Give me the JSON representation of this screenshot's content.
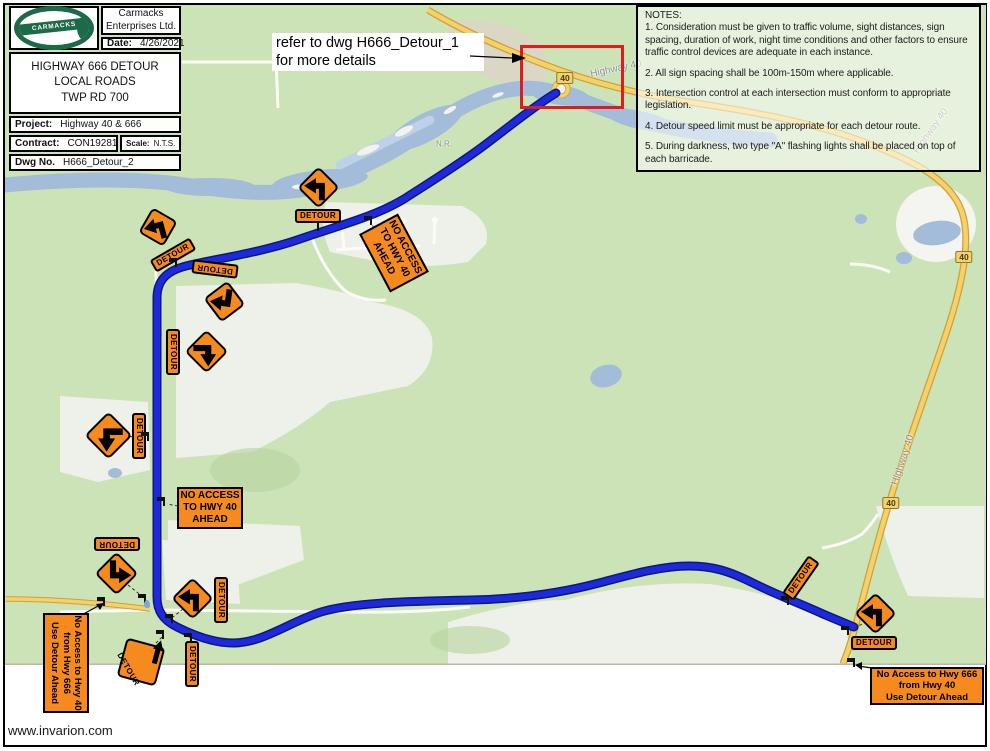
{
  "colors": {
    "route_blue": "#1c2adc",
    "sign_orange": "#f68a1e",
    "highway_yellow": "#f7d168",
    "water": "#a3bcd9",
    "map_green": "#cbe3b6",
    "field_gray": "#eef0ea",
    "callout_red": "#e01b1b"
  },
  "title_block": {
    "logo_text": "CARMACKS",
    "company_line1": "Carmacks",
    "company_line2": "Enterprises Ltd.",
    "date_label": "Date:",
    "date_value": "4/26/2021",
    "drawing_title_line1": "HIGHWAY 666 DETOUR",
    "drawing_title_line2": "LOCAL ROADS",
    "drawing_title_line3": "TWP RD 700",
    "project_label": "Project:",
    "project_value": "Highway 40 & 666",
    "contract_label": "Contract:",
    "contract_value": "CON19281",
    "scale_label": "Scale:",
    "scale_value": "N.T.S.",
    "dwg_label": "Dwg No.",
    "dwg_value": "H666_Detour_2"
  },
  "callout": {
    "line1": "refer to dwg H666_Detour_1",
    "line2": "for more details"
  },
  "notes": {
    "heading": "NOTES:",
    "items": [
      "1. Consideration must be given to traffic volume, sight distances, sign spacing, duration of work, night time conditions and other factors to ensure traffic control devices are adequate in each instance.",
      "2. All sign spacing shall be 100m-150m where applicable.",
      "3. Intersection control at each intersection must conform to appropriate legislation.",
      "4. Detour speed limit must be appropriate for each detour route.",
      "5. During darkness, two type \"A\" flashing lights shall be placed on top of each barricade."
    ]
  },
  "footer": {
    "website": "www.invarion.com"
  },
  "map": {
    "shields": [
      {
        "label": "40",
        "x": 565,
        "y": 78
      },
      {
        "label": "40",
        "x": 964,
        "y": 257
      },
      {
        "label": "40",
        "x": 891,
        "y": 503
      }
    ],
    "road_labels": [
      {
        "text": "Highway 40",
        "x": 616,
        "y": 69,
        "rot": -12
      },
      {
        "text": "Highway 40",
        "x": 931,
        "y": 131,
        "rot": -55
      },
      {
        "text": "Highway 40",
        "x": 903,
        "y": 460,
        "rot": -72
      },
      {
        "text": "N.R.",
        "x": 444,
        "y": 144,
        "rot": 0
      }
    ],
    "signs": [
      {
        "id": "detour-sign-a",
        "x": 318,
        "y": 187,
        "size": 30,
        "rot": 0,
        "arrow": "up-left",
        "plaque": {
          "text": "DETOUR",
          "x": 318,
          "y": 216,
          "rot": 0
        }
      },
      {
        "id": "detour-sign-b",
        "x": 158,
        "y": 227,
        "size": 29,
        "rot": -15,
        "arrow": "up-left",
        "plaque": {
          "text": "DETOUR",
          "x": 173,
          "y": 255,
          "rot": -30
        }
      },
      {
        "id": "detour-sign-c",
        "x": 224,
        "y": 301,
        "size": 30,
        "rot": 8,
        "arrow": "down-left",
        "plaque": {
          "text": "DETOUR",
          "x": 215,
          "y": 269,
          "rot": 187
        }
      },
      {
        "id": "detour-sign-d",
        "x": 206,
        "y": 351,
        "size": 31,
        "rot": 0,
        "arrow": "right-down",
        "plaque": {
          "text": "DETOUR",
          "x": 173,
          "y": 352,
          "rot": 90
        }
      },
      {
        "id": "detour-sign-e",
        "x": 108,
        "y": 435,
        "size": 34,
        "rot": 0,
        "arrow": "left-down",
        "plaque": {
          "text": "DETOUR",
          "x": 139,
          "y": 436,
          "rot": 90
        }
      },
      {
        "id": "detour-sign-f",
        "x": 116,
        "y": 573,
        "size": 31,
        "rot": 0,
        "arrow": "down-right",
        "plaque": {
          "text": "DETOUR",
          "x": 117,
          "y": 544,
          "rot": 180
        }
      },
      {
        "id": "detour-sign-g",
        "x": 141,
        "y": 662,
        "size": 40,
        "rot": -30,
        "arrow": "ne",
        "inner_text": "DETOUR"
      },
      {
        "id": "detour-sign-h",
        "x": 192,
        "y": 598,
        "size": 30,
        "rot": 0,
        "arrow": "up-left",
        "plaque": {
          "text": "DETOUR",
          "x": 221,
          "y": 600,
          "rot": 90
        }
      },
      {
        "id": "detour-sign-i",
        "plaque_only": true,
        "plaque": {
          "text": "DETOUR",
          "x": 192,
          "y": 664,
          "rot": 90
        }
      },
      {
        "id": "detour-sign-j",
        "x": 875,
        "y": 613,
        "size": 30,
        "rot": 0,
        "arrow": "up-left",
        "plaque": {
          "text": "DETOUR",
          "x": 874,
          "y": 643,
          "rot": 0
        }
      },
      {
        "id": "detour-sign-k",
        "plaque_only": true,
        "plaque": {
          "text": "DETOUR",
          "x": 801,
          "y": 578,
          "rot": -55
        }
      }
    ],
    "access_boxes": [
      {
        "id": "no-access-hwy40-rotated",
        "style": "bold",
        "lines": [
          "NO ACCESS",
          "TO HWY 40",
          "AHEAD"
        ],
        "x": 394,
        "y": 253,
        "w": 66,
        "h": 44,
        "rot": 62
      },
      {
        "id": "no-access-hwy40",
        "style": "bold",
        "lines": [
          "NO ACCESS",
          "TO HWY 40",
          "AHEAD"
        ],
        "x": 210,
        "y": 508,
        "w": 66,
        "h": 42,
        "rot": 0
      },
      {
        "id": "no-access-hwy40-from-666",
        "style": "norm",
        "lines": [
          "No Access to Hwy 40",
          "from Hwy 666",
          "Use Detour Ahead"
        ],
        "x": 66,
        "y": 663,
        "w": 100,
        "h": 46,
        "rot": 90
      },
      {
        "id": "no-access-hwy666-from-40",
        "style": "norm",
        "lines": [
          "No Access to Hwy 666",
          "from Hwy 40",
          "Use Detour Ahead"
        ],
        "x": 927,
        "y": 686,
        "w": 114,
        "h": 38,
        "rot": 0
      }
    ],
    "markers": [
      {
        "x": 318,
        "y": 231,
        "type": "post"
      },
      {
        "x": 176,
        "y": 267
      },
      {
        "x": 371,
        "y": 225
      },
      {
        "x": 148,
        "y": 441
      },
      {
        "x": 164,
        "y": 506
      },
      {
        "x": 104,
        "y": 606
      },
      {
        "x": 145,
        "y": 603
      },
      {
        "x": 172,
        "y": 623
      },
      {
        "x": 163,
        "y": 639
      },
      {
        "x": 191,
        "y": 642
      },
      {
        "x": 788,
        "y": 605
      },
      {
        "x": 848,
        "y": 635
      },
      {
        "x": 854,
        "y": 667
      }
    ]
  }
}
